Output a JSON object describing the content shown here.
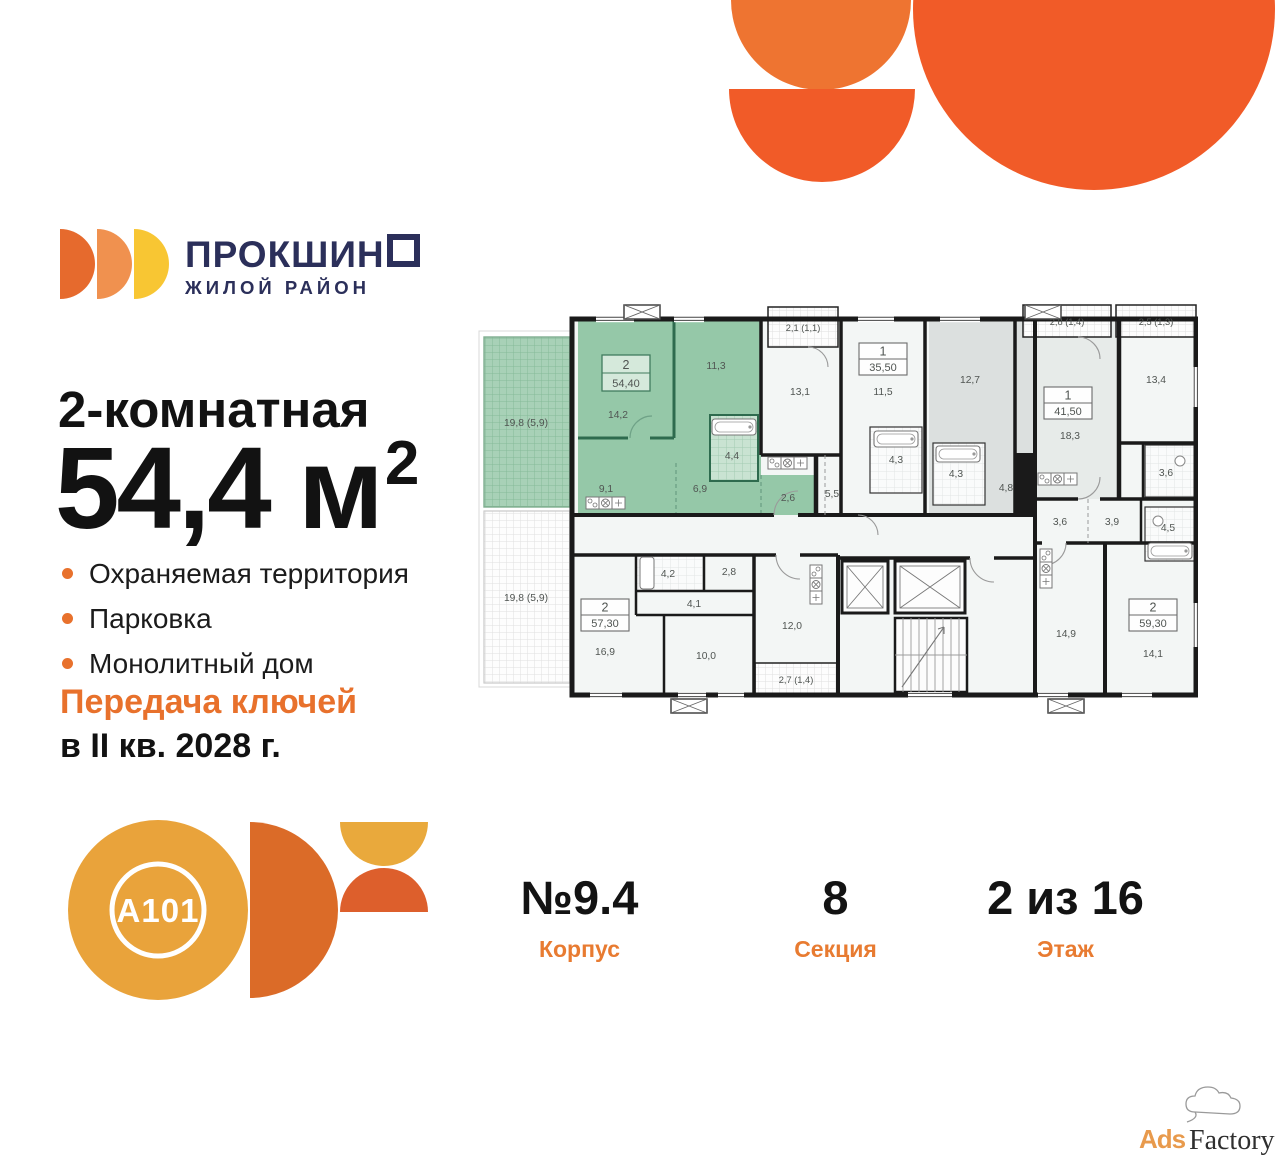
{
  "colors": {
    "accent_orange": "#E8712C",
    "brand_navy": "#2B2F5A",
    "highlight_green": "#95C8A8",
    "shape_orange": "#F15B28",
    "shape_orange_light": "#EE7431",
    "logo_gold": "#E9A33B"
  },
  "brand": {
    "name_head": "ПРОКШИН",
    "name_tail": "О",
    "subtitle": "ЖИЛОЙ РАЙОН"
  },
  "listing": {
    "rooms_type": "2-комнатная",
    "area_value": "54,4",
    "area_unit": "м",
    "area_sup": "2",
    "features": [
      "Охраняемая территория",
      "Парковка",
      "Монолитный дом"
    ],
    "handover_line1": "Передача ключей",
    "handover_line2": "в II кв. 2028 г."
  },
  "details": {
    "building": {
      "value": "№9.4",
      "label": "Корпус"
    },
    "section": {
      "value": "8",
      "label": "Секция"
    },
    "floor": {
      "value": "2 из 16",
      "label": "Этаж"
    }
  },
  "developer": {
    "logo_text": "A101"
  },
  "watermark": {
    "ads": "Ads",
    "factory": "Factory"
  },
  "plan": {
    "units": {
      "main": {
        "rooms": "2",
        "area": "54,40"
      },
      "a355": {
        "rooms": "1",
        "area": "35,50"
      },
      "a415": {
        "rooms": "1",
        "area": "41,50"
      },
      "a573": {
        "rooms": "2",
        "area": "57,30"
      },
      "a593": {
        "rooms": "2",
        "area": "59,30"
      }
    },
    "rooms": {
      "terrace_top": "19,8 (5,9)",
      "terrace_bottom": "19,8 (5,9)",
      "balcony_21": "2,1 (1,1)",
      "balcony_28": "2,8 (1,4)",
      "balcony_25": "2,5 (1,3)",
      "balcony_27": "2,7 (1,4)",
      "r142": "14,2",
      "r113": "11,3",
      "r91": "9,1",
      "r69": "6,9",
      "r44": "4,4",
      "r26": "2,6",
      "r131": "13,1",
      "r115": "11,5",
      "r55": "5,5",
      "r43a": "4,3",
      "r127": "12,7",
      "r43b": "4,3",
      "r48": "4,8",
      "r183": "18,3",
      "r134": "13,4",
      "r36a": "3,6",
      "r36b": "3,6",
      "r39": "3,9",
      "r45": "4,5",
      "r42": "4,2",
      "r28": "2,8",
      "r41": "4,1",
      "r169": "16,9",
      "r100": "10,0",
      "r120": "12,0",
      "r149": "14,9",
      "r141": "14,1"
    }
  }
}
